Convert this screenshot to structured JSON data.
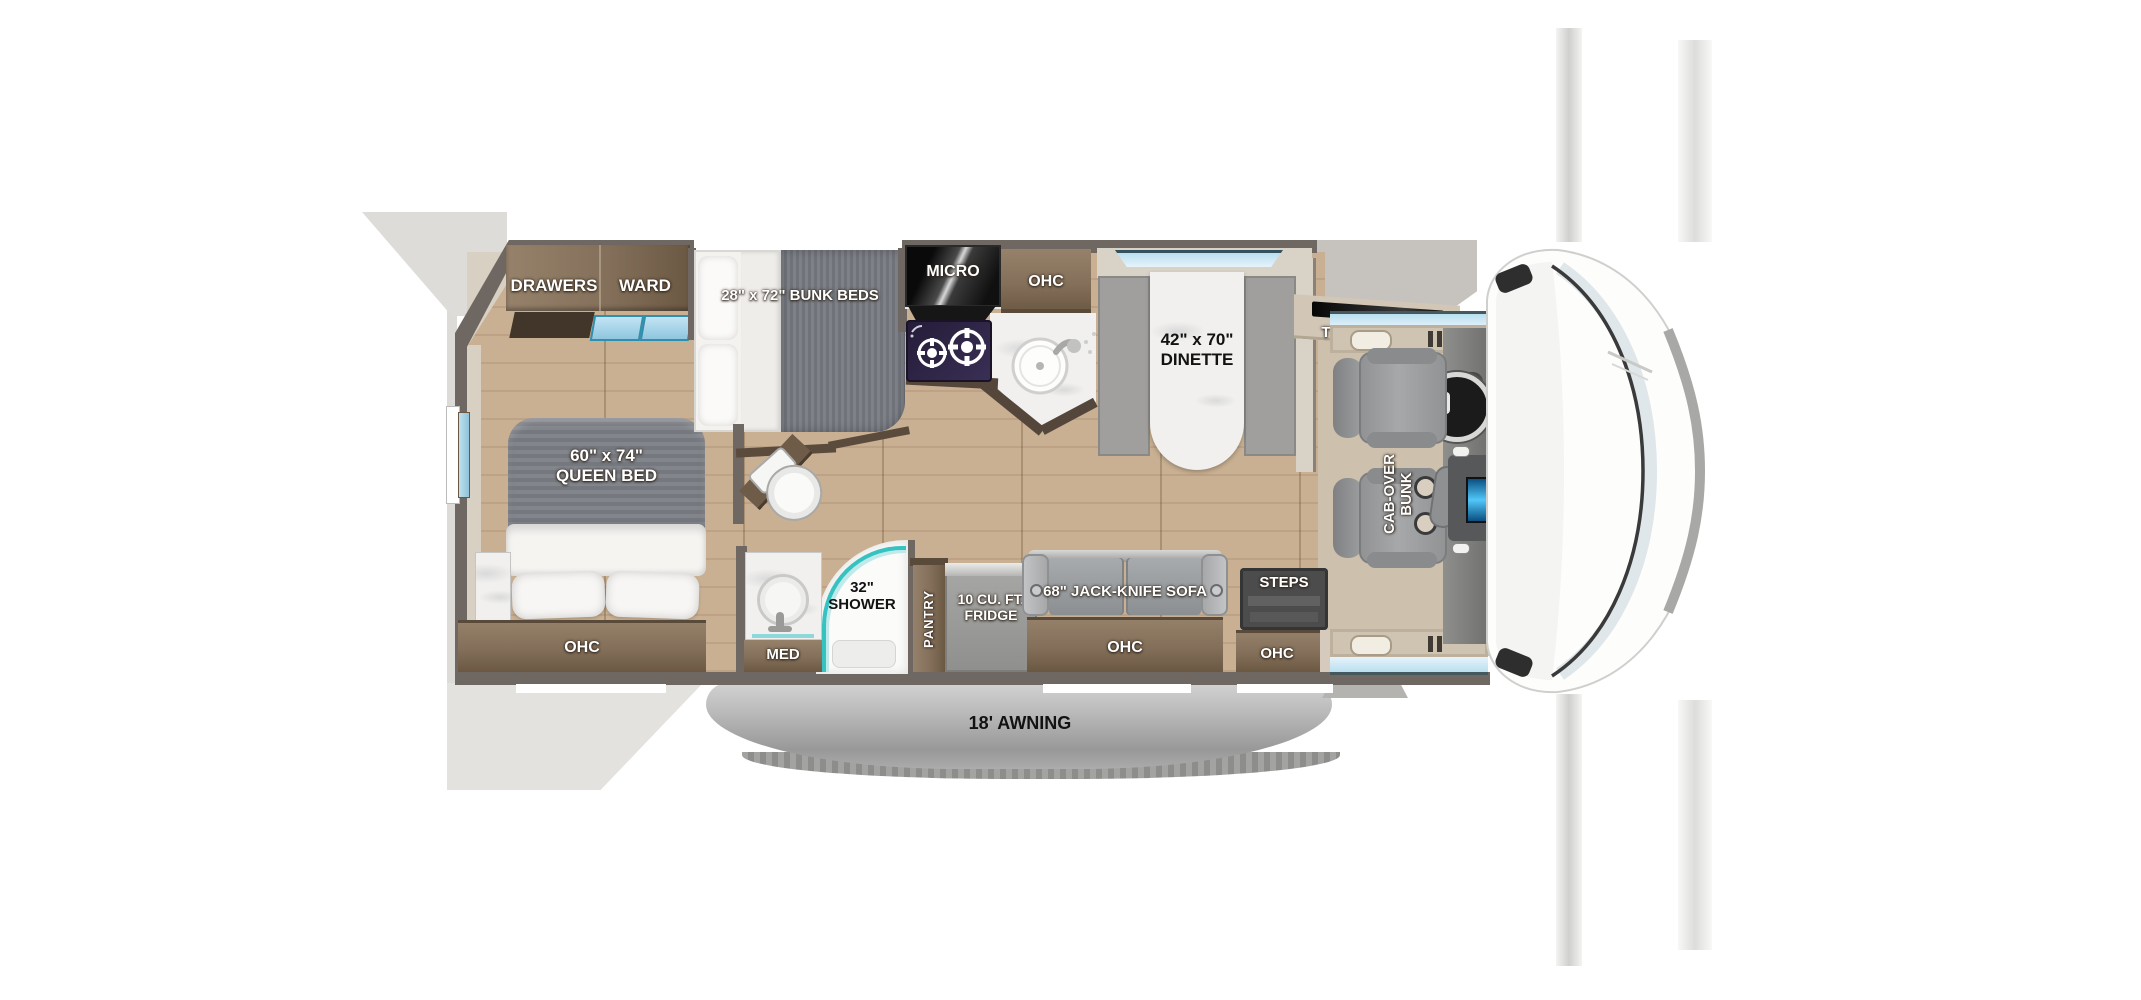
{
  "labels": {
    "drawers": "DRAWERS",
    "ward": "WARD",
    "bunk_beds": "28\" x 72\" BUNK BEDS",
    "micro": "MICRO",
    "kitchen_ohc": "OHC",
    "dinette": "42\" x 70\"\nDINETTE",
    "tv": "TV",
    "cab_over_bunk": "CAB-OVER\nBUNK",
    "queen_bed": "60\" x 74\"\nQUEEN BED",
    "bath_ohc": "OHC",
    "bed_ohc": "OHC",
    "med": "MED",
    "shower": "32\"\nSHOWER",
    "pantry": "PANTRY",
    "fridge": "10 CU. FT.\nFRIDGE",
    "sofa": "68\" JACK-KNIFE SOFA",
    "sofa_ohc": "OHC",
    "steps": "STEPS",
    "entry_ohc": "OHC",
    "awning": "18' AWNING"
  },
  "colors": {
    "wall": "#6f6761",
    "floor_wood": "#c9b092",
    "cabinet_brown": "#84705a",
    "accent_teal": "#35c2c0",
    "glass_blue": "#cfe9f5",
    "marble_white": "#f1f0ee",
    "sofa_gray": "#a6a9ab",
    "awning_gray": "#b5b5b5",
    "cab_beige": "#cdc0ac"
  }
}
